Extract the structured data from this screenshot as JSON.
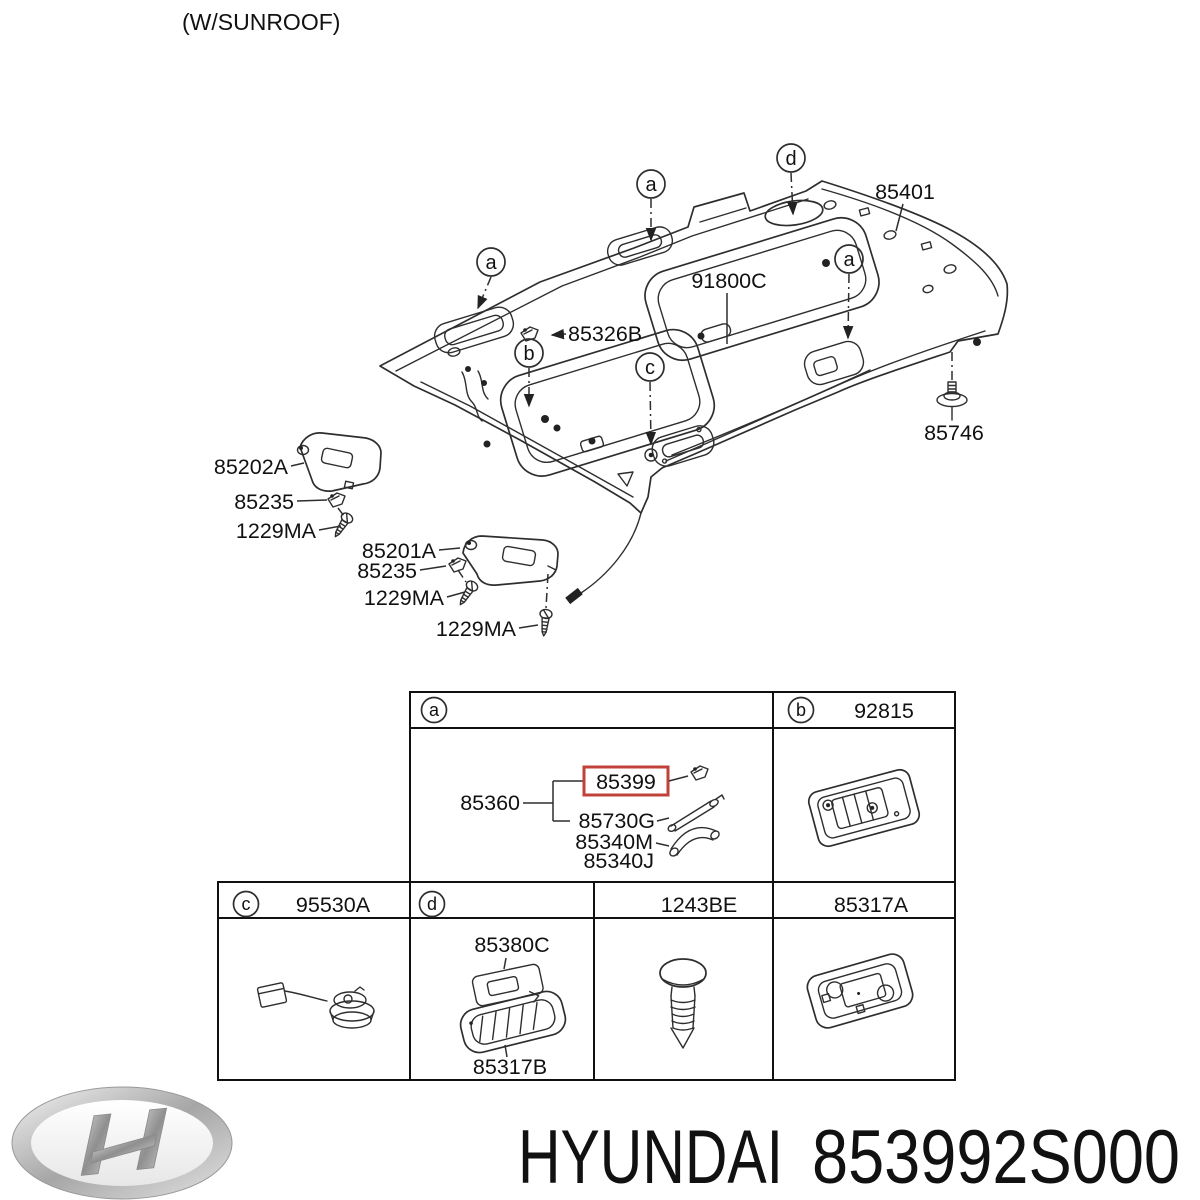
{
  "page": {
    "note": "(W/SUNROOF)"
  },
  "colors": {
    "highlight_box": "#c0413a",
    "line": "#2e2e2e",
    "text": "#111111"
  },
  "diagram": {
    "callouts": {
      "a": "a",
      "b": "b",
      "c": "c",
      "d": "d"
    },
    "labels": {
      "roof_panel": "85401",
      "sunroof_assy": "91800C",
      "retainer": "85326B",
      "fastener_clip": "85746",
      "visor_lh": "85202A",
      "visor_lh_clip": "85235",
      "visor_lh_screw": "1229MA",
      "visor_rh": "85201A",
      "visor_rh_clip": "85235",
      "visor_rh_screw": "1229MA",
      "visor_rh_pivot_screw": "1229MA"
    }
  },
  "table": {
    "cell_a": {
      "letter": "a",
      "group": "85360",
      "highlighted": "85399",
      "strap": "85730G",
      "handle_m": "85340M",
      "handle_j": "85340J"
    },
    "cell_b": {
      "letter": "b",
      "part": "92815"
    },
    "cell_c": {
      "letter": "c",
      "part": "95530A"
    },
    "cell_d": {
      "letter": "d",
      "lens_part": "85380C",
      "lamp_part": "85317B"
    },
    "cell_screw": {
      "part": "1243BE"
    },
    "cell_base": {
      "part": "85317A"
    }
  },
  "footer": {
    "brand": "HYUNDAI",
    "part_number": "853992S000"
  }
}
